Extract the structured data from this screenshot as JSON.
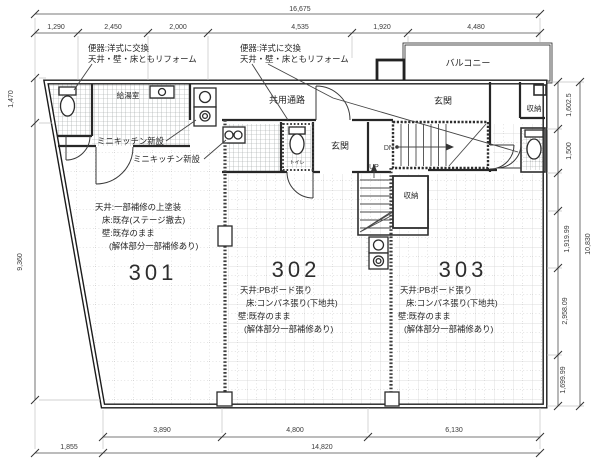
{
  "drawing": {
    "notes": {
      "toilet_left": [
        "便器:洋式に交換",
        "天井・壁・床ともリフォーム"
      ],
      "toilet_right": [
        "便器:洋式に交換",
        "天井・壁・床ともリフォーム"
      ],
      "mini_kitchen_a": "ミニキッチン新設",
      "mini_kitchen_b": "ミニキッチン新設"
    },
    "labels": {
      "balcony": "バルコニー",
      "corridor": "共用通路",
      "pantry": "給湯室",
      "entrance_center": "玄関",
      "entrance_right": "玄関",
      "storage_right": "収納",
      "storage_stair": "収納",
      "toilet": "トイレ",
      "down": "DN",
      "up": "UP"
    },
    "rooms": [
      {
        "number": "301",
        "notes": [
          "天井:一部補修の上塗装",
          "床:既存(ステージ撤去)",
          "壁:既存のまま",
          "(解体部分一部補修あり)"
        ]
      },
      {
        "number": "302",
        "notes": [
          "天井:PBボード張り",
          "床:コンパネ張り(下地共)",
          "壁:既存のまま",
          "(解体部分一部補修あり)"
        ]
      },
      {
        "number": "303",
        "notes": [
          "天井:PBボード張り",
          "床:コンパネ張り(下地共)",
          "壁:既存のまま",
          "(解体部分一部補修あり)"
        ]
      }
    ],
    "dimensions": {
      "top_total": "16,675",
      "top_segments": [
        "1,290",
        "2,450",
        "2,000",
        "4,535",
        "1,920",
        "4,480"
      ],
      "left_segments": [
        "1,470",
        "9,360"
      ],
      "right_segments": [
        "1,602.5",
        "1,500",
        "1,919.99",
        "2,958.09",
        "1,699.99"
      ],
      "right_total": "10,830",
      "bottom_segments": [
        "3,890",
        "4,800",
        "6,130"
      ],
      "bottom_offset": "1,855",
      "bottom_total": "14,820"
    },
    "colors": {
      "line": "#1f1f1f",
      "grid": "#cccccc",
      "hatch": "#9a9a9a",
      "background": "#ffffff"
    }
  }
}
